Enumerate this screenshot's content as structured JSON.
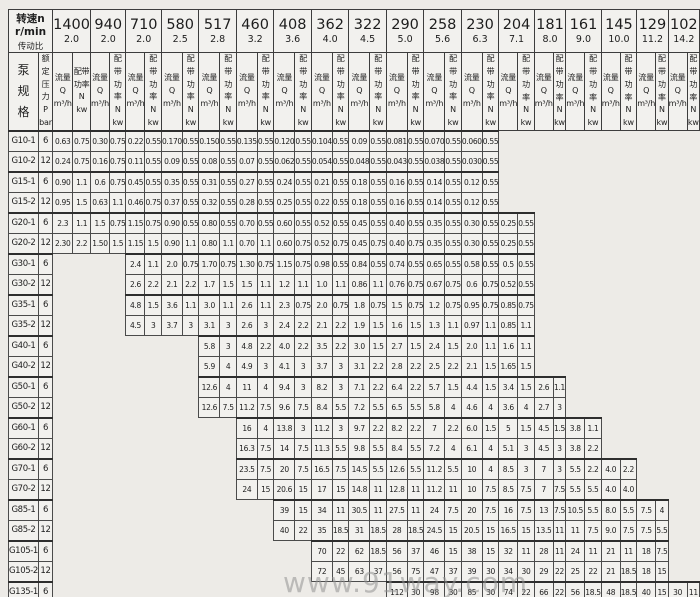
{
  "header": {
    "speed_label": "转速n r/min",
    "ratio_label": "传动比",
    "pump_spec_chars": [
      "泵",
      "规",
      "格"
    ],
    "pressure_lines": [
      "额定",
      "压力",
      "P",
      "bar"
    ],
    "flow_lines": [
      "流量",
      "Q",
      "m³/h"
    ],
    "power_lines": [
      "配带",
      "功率",
      "N",
      "kw"
    ]
  },
  "speeds": [
    {
      "rpm": "1400",
      "ratio": "2.0"
    },
    {
      "rpm": "940",
      "ratio": "2.0"
    },
    {
      "rpm": "710",
      "ratio": "2.0"
    },
    {
      "rpm": "580",
      "ratio": "2.5"
    },
    {
      "rpm": "517",
      "ratio": "2.8"
    },
    {
      "rpm": "460",
      "ratio": "3.2"
    },
    {
      "rpm": "408",
      "ratio": "3.6"
    },
    {
      "rpm": "362",
      "ratio": "4.0"
    },
    {
      "rpm": "322",
      "ratio": "4.5"
    },
    {
      "rpm": "290",
      "ratio": "5.0"
    },
    {
      "rpm": "258",
      "ratio": "5.6"
    },
    {
      "rpm": "230",
      "ratio": "6.3"
    },
    {
      "rpm": "204",
      "ratio": "7.1"
    },
    {
      "rpm": "181",
      "ratio": "8.0"
    },
    {
      "rpm": "161",
      "ratio": "9.0"
    },
    {
      "rpm": "145",
      "ratio": "10.0"
    },
    {
      "rpm": "129",
      "ratio": "11.2"
    },
    {
      "rpm": "102",
      "ratio": "14.2"
    }
  ],
  "rows": [
    {
      "model": "G10-1",
      "pressure": "6",
      "start": 0,
      "values": [
        [
          "0.63",
          "0.75"
        ],
        [
          "0.30",
          "0.75"
        ],
        [
          "0.22",
          "0.55"
        ],
        [
          "0.170",
          "0.55"
        ],
        [
          "0.150",
          "0.55"
        ],
        [
          "0.135",
          "0.55"
        ],
        [
          "0.120",
          "0.55"
        ],
        [
          "0.104",
          "0.55"
        ],
        [
          "0.09",
          "0.55"
        ],
        [
          "0.081",
          "0.55"
        ],
        [
          "0.070",
          "0.55"
        ],
        [
          "0.060",
          "0.55"
        ]
      ]
    },
    {
      "model": "G10-2",
      "pressure": "12",
      "start": 0,
      "values": [
        [
          "0.24",
          "0.75"
        ],
        [
          "0.16",
          "0.75"
        ],
        [
          "0.11",
          "0.55"
        ],
        [
          "0.09",
          "0.55"
        ],
        [
          "0.08",
          "0.55"
        ],
        [
          "0.07",
          "0.55"
        ],
        [
          "0.062",
          "0.55"
        ],
        [
          "0.054",
          "0.55"
        ],
        [
          "0.048",
          "0.55"
        ],
        [
          "0.043",
          "0.55"
        ],
        [
          "0.038",
          "0.55"
        ],
        [
          "0.030",
          "0.55"
        ]
      ]
    },
    {
      "model": "G15-1",
      "pressure": "6",
      "start": 0,
      "values": [
        [
          "0.90",
          "1.1"
        ],
        [
          "0.6",
          "0.75"
        ],
        [
          "0.45",
          "0.55"
        ],
        [
          "0.35",
          "0.55"
        ],
        [
          "0.31",
          "0.55"
        ],
        [
          "0.27",
          "0.55"
        ],
        [
          "0.24",
          "0.55"
        ],
        [
          "0.21",
          "0.55"
        ],
        [
          "0.18",
          "0.55"
        ],
        [
          "0.16",
          "0.55"
        ],
        [
          "0.14",
          "0.55"
        ],
        [
          "0.12",
          "0.55"
        ]
      ]
    },
    {
      "model": "G15-2",
      "pressure": "12",
      "start": 0,
      "values": [
        [
          "0.95",
          "1.5"
        ],
        [
          "0.63",
          "1.1"
        ],
        [
          "0.46",
          "0.75"
        ],
        [
          "0.37",
          "0.55"
        ],
        [
          "0.32",
          "0.55"
        ],
        [
          "0.28",
          "0.55"
        ],
        [
          "0.25",
          "0.55"
        ],
        [
          "0.22",
          "0.55"
        ],
        [
          "0.18",
          "0.55"
        ],
        [
          "0.16",
          "0.55"
        ],
        [
          "0.14",
          "0.55"
        ],
        [
          "0.12",
          "0.55"
        ]
      ]
    },
    {
      "model": "G20-1",
      "pressure": "6",
      "start": 0,
      "values": [
        [
          "2.3",
          "1.1"
        ],
        [
          "1.5",
          "0.75"
        ],
        [
          "1.15",
          "0.75"
        ],
        [
          "0.90",
          "0.55"
        ],
        [
          "0.80",
          "0.55"
        ],
        [
          "0.70",
          "0.55"
        ],
        [
          "0.60",
          "0.55"
        ],
        [
          "0.52",
          "0.55"
        ],
        [
          "0.45",
          "0.55"
        ],
        [
          "0.40",
          "0.55"
        ],
        [
          "0.35",
          "0.55"
        ],
        [
          "0.30",
          "0.55"
        ],
        [
          "0.25",
          "0.55"
        ]
      ]
    },
    {
      "model": "G20-2",
      "pressure": "12",
      "start": 0,
      "values": [
        [
          "2.30",
          "2.2"
        ],
        [
          "1.50",
          "1.5"
        ],
        [
          "1.15",
          "1.5"
        ],
        [
          "0.90",
          "1.1"
        ],
        [
          "0.80",
          "1.1"
        ],
        [
          "0.70",
          "1.1"
        ],
        [
          "0.60",
          "0.75"
        ],
        [
          "0.52",
          "0.75"
        ],
        [
          "0.45",
          "0.75"
        ],
        [
          "0.40",
          "0.75"
        ],
        [
          "0.35",
          "0.55"
        ],
        [
          "0.30",
          "0.55"
        ],
        [
          "0.25",
          "0.55"
        ]
      ]
    },
    {
      "model": "G30-1",
      "pressure": "6",
      "start": 2,
      "values": [
        [
          "2.4",
          "1.1"
        ],
        [
          "2.0",
          "0.75"
        ],
        [
          "1.70",
          "0.75"
        ],
        [
          "1.30",
          "0.75"
        ],
        [
          "1.15",
          "0.75"
        ],
        [
          "0.98",
          "0.55"
        ],
        [
          "0.84",
          "0.55"
        ],
        [
          "0.74",
          "0.55"
        ],
        [
          "0.65",
          "0.55"
        ],
        [
          "0.58",
          "0.55"
        ],
        [
          "0.5",
          "0.55"
        ]
      ]
    },
    {
      "model": "G30-2",
      "pressure": "12",
      "start": 2,
      "values": [
        [
          "2.6",
          "2.2"
        ],
        [
          "2.1",
          "2.2"
        ],
        [
          "1.7",
          "1.5"
        ],
        [
          "1.5",
          "1.1"
        ],
        [
          "1.2",
          "1.1"
        ],
        [
          "1.0",
          "1.1"
        ],
        [
          "0.86",
          "1.1"
        ],
        [
          "0.76",
          "0.75"
        ],
        [
          "0.67",
          "0.75"
        ],
        [
          "0.6",
          "0.75"
        ],
        [
          "0.52",
          "0.55"
        ]
      ]
    },
    {
      "model": "G35-1",
      "pressure": "6",
      "start": 2,
      "values": [
        [
          "4.8",
          "1.5"
        ],
        [
          "3.6",
          "1.1"
        ],
        [
          "3.0",
          "1.1"
        ],
        [
          "2.6",
          "1.1"
        ],
        [
          "2.3",
          "0.75"
        ],
        [
          "2.0",
          "0.75"
        ],
        [
          "1.8",
          "0.75"
        ],
        [
          "1.5",
          "0.75"
        ],
        [
          "1.2",
          "0.75"
        ],
        [
          "0.95",
          "0.75"
        ],
        [
          "0.85",
          "0.75"
        ]
      ]
    },
    {
      "model": "G35-2",
      "pressure": "12",
      "start": 2,
      "values": [
        [
          "4.5",
          "3"
        ],
        [
          "3.7",
          "3"
        ],
        [
          "3.1",
          "3"
        ],
        [
          "2.6",
          "3"
        ],
        [
          "2.4",
          "2.2"
        ],
        [
          "2.1",
          "2.2"
        ],
        [
          "1.9",
          "1.5"
        ],
        [
          "1.6",
          "1.5"
        ],
        [
          "1.3",
          "1.1"
        ],
        [
          "0.97",
          "1.1"
        ],
        [
          "0.85",
          "1.1"
        ]
      ]
    },
    {
      "model": "G40-1",
      "pressure": "6",
      "start": 4,
      "values": [
        [
          "5.8",
          "3"
        ],
        [
          "4.8",
          "2.2"
        ],
        [
          "4.0",
          "2.2"
        ],
        [
          "3.5",
          "2.2"
        ],
        [
          "3.0",
          "1.5"
        ],
        [
          "2.7",
          "1.5"
        ],
        [
          "2.4",
          "1.5"
        ],
        [
          "2.0",
          "1.1"
        ],
        [
          "1.6",
          "1.1"
        ]
      ]
    },
    {
      "model": "G40-2",
      "pressure": "12",
      "start": 4,
      "values": [
        [
          "5.9",
          "4"
        ],
        [
          "4.9",
          "3"
        ],
        [
          "4.1",
          "3"
        ],
        [
          "3.7",
          "3"
        ],
        [
          "3.1",
          "2.2"
        ],
        [
          "2.8",
          "2.2"
        ],
        [
          "2.5",
          "2.2"
        ],
        [
          "2.1",
          "1.5"
        ],
        [
          "1.65",
          "1.5"
        ]
      ]
    },
    {
      "model": "G50-1",
      "pressure": "6",
      "start": 4,
      "values": [
        [
          "12.6",
          "4"
        ],
        [
          "11",
          "4"
        ],
        [
          "9.4",
          "3"
        ],
        [
          "8.2",
          "3"
        ],
        [
          "7.1",
          "2.2"
        ],
        [
          "6.4",
          "2.2"
        ],
        [
          "5.7",
          "1.5"
        ],
        [
          "4.4",
          "1.5"
        ],
        [
          "3.4",
          "1.5"
        ],
        [
          "2.6",
          "1.1"
        ]
      ]
    },
    {
      "model": "G50-2",
      "pressure": "12",
      "start": 4,
      "values": [
        [
          "12.6",
          "7.5"
        ],
        [
          "11.2",
          "7.5"
        ],
        [
          "9.6",
          "7.5"
        ],
        [
          "8.4",
          "5.5"
        ],
        [
          "7.2",
          "5.5"
        ],
        [
          "6.5",
          "5.5"
        ],
        [
          "5.8",
          "4"
        ],
        [
          "4.6",
          "4"
        ],
        [
          "3.6",
          "4"
        ],
        [
          "2.7",
          "3"
        ]
      ]
    },
    {
      "model": "G60-1",
      "pressure": "6",
      "start": 5,
      "values": [
        [
          "16",
          "4"
        ],
        [
          "13.8",
          "3"
        ],
        [
          "11.2",
          "3"
        ],
        [
          "9.7",
          "2.2"
        ],
        [
          "8.2",
          "2.2"
        ],
        [
          "7",
          "2.2"
        ],
        [
          "6.0",
          "1.5"
        ],
        [
          "5",
          "1.5"
        ],
        [
          "4.5",
          "1.5"
        ],
        [
          "3.8",
          "1.1"
        ]
      ]
    },
    {
      "model": "G60-2",
      "pressure": "12",
      "start": 5,
      "values": [
        [
          "16.3",
          "7.5"
        ],
        [
          "14",
          "7.5"
        ],
        [
          "11.3",
          "5.5"
        ],
        [
          "9.8",
          "5.5"
        ],
        [
          "8.4",
          "5.5"
        ],
        [
          "7.2",
          "4"
        ],
        [
          "6.1",
          "4"
        ],
        [
          "5.1",
          "3"
        ],
        [
          "4.5",
          "3"
        ],
        [
          "3.8",
          "2.2"
        ]
      ]
    },
    {
      "model": "G70-1",
      "pressure": "6",
      "start": 5,
      "values": [
        [
          "23.5",
          "7.5"
        ],
        [
          "20",
          "7.5"
        ],
        [
          "16.5",
          "7.5"
        ],
        [
          "14.5",
          "5.5"
        ],
        [
          "12.6",
          "5.5"
        ],
        [
          "11.2",
          "5.5"
        ],
        [
          "10",
          "4"
        ],
        [
          "8.5",
          "3"
        ],
        [
          "7",
          "3"
        ],
        [
          "5.5",
          "2.2"
        ],
        [
          "4.0",
          "2.2"
        ]
      ]
    },
    {
      "model": "G70-2",
      "pressure": "12",
      "start": 5,
      "values": [
        [
          "24",
          "15"
        ],
        [
          "20.6",
          "15"
        ],
        [
          "17",
          "15"
        ],
        [
          "14.8",
          "11"
        ],
        [
          "12.8",
          "11"
        ],
        [
          "11.2",
          "11"
        ],
        [
          "10",
          "7.5"
        ],
        [
          "8.5",
          "7.5"
        ],
        [
          "7",
          "7.5"
        ],
        [
          "5.5",
          "5.5"
        ],
        [
          "4.0",
          "4.0"
        ]
      ]
    },
    {
      "model": "G85-1",
      "pressure": "6",
      "start": 6,
      "values": [
        [
          "39",
          "15"
        ],
        [
          "34",
          "11"
        ],
        [
          "30.5",
          "11"
        ],
        [
          "27.5",
          "11"
        ],
        [
          "24",
          "7.5"
        ],
        [
          "20",
          "7.5"
        ],
        [
          "16",
          "7.5"
        ],
        [
          "13",
          "7.5"
        ],
        [
          "10.5",
          "5.5"
        ],
        [
          "8.0",
          "5.5"
        ],
        [
          "7.5",
          "4"
        ]
      ]
    },
    {
      "model": "G85-2",
      "pressure": "12",
      "start": 6,
      "values": [
        [
          "40",
          "22"
        ],
        [
          "35",
          "18.5"
        ],
        [
          "31",
          "18.5"
        ],
        [
          "28",
          "18.5"
        ],
        [
          "24.5",
          "15"
        ],
        [
          "20.5",
          "15"
        ],
        [
          "16.5",
          "15"
        ],
        [
          "13.5",
          "11"
        ],
        [
          "11",
          "7.5"
        ],
        [
          "9.0",
          "7.5"
        ],
        [
          "7.5",
          "5.5"
        ]
      ]
    },
    {
      "model": "G105-1",
      "pressure": "6",
      "start": 7,
      "values": [
        [
          "70",
          "22"
        ],
        [
          "62",
          "18.5"
        ],
        [
          "56",
          "37"
        ],
        [
          "46",
          "15"
        ],
        [
          "38",
          "15"
        ],
        [
          "32",
          "11"
        ],
        [
          "28",
          "11"
        ],
        [
          "24",
          "11"
        ],
        [
          "21",
          "11"
        ],
        [
          "18",
          "7.5"
        ]
      ]
    },
    {
      "model": "G105-2",
      "pressure": "12",
      "start": 7,
      "values": [
        [
          "72",
          "45"
        ],
        [
          "63",
          "37"
        ],
        [
          "56",
          "75"
        ],
        [
          "47",
          "37"
        ],
        [
          "39",
          "30"
        ],
        [
          "34",
          "30"
        ],
        [
          "29",
          "22"
        ],
        [
          "25",
          "22"
        ],
        [
          "21",
          "18.5"
        ],
        [
          "18",
          "15"
        ]
      ]
    },
    {
      "model": "G135-1",
      "pressure": "6",
      "start": 9,
      "values": [
        [
          "112",
          "30"
        ],
        [
          "98",
          "30"
        ],
        [
          "85",
          "30"
        ],
        [
          "74",
          "22"
        ],
        [
          "66",
          "22"
        ],
        [
          "56",
          "18.5"
        ],
        [
          "48",
          "18.5"
        ],
        [
          "40",
          "15"
        ],
        [
          "30",
          "11"
        ]
      ]
    },
    {
      "model": "G135-2",
      "pressure": "12",
      "start": 9,
      "values": [
        [
          "116",
          "75"
        ],
        [
          "100",
          "75"
        ],
        [
          "87",
          "55"
        ],
        [
          "76",
          "45"
        ],
        [
          "66",
          "55"
        ],
        [
          "56",
          "45"
        ],
        [
          "48",
          "37"
        ],
        [
          "42",
          "30"
        ],
        [
          "32",
          "22"
        ]
      ]
    }
  ],
  "watermark": "www.91way.com"
}
